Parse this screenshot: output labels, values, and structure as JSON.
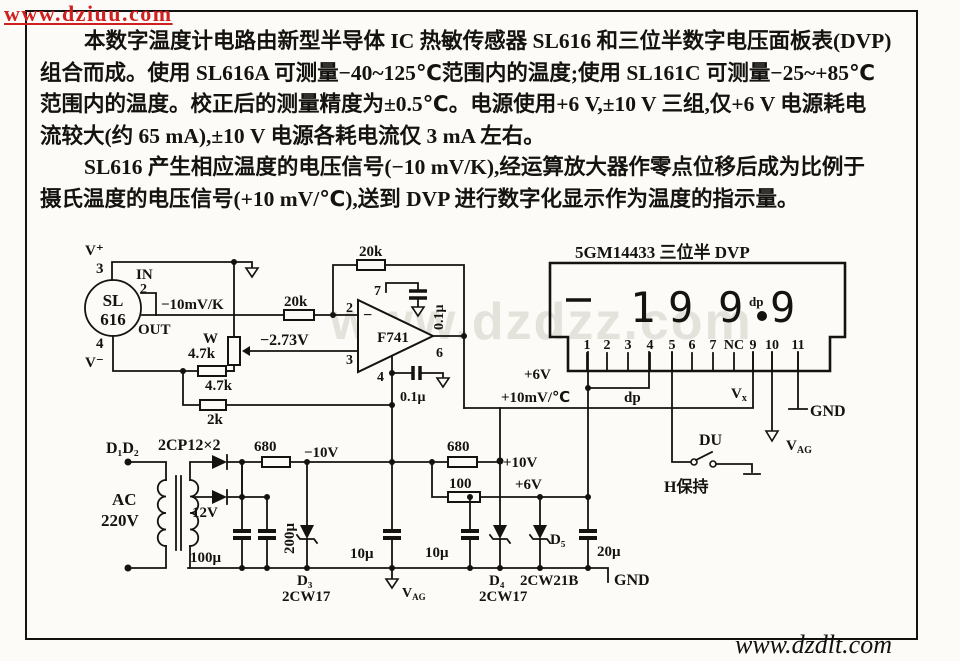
{
  "watermarks": {
    "top_left": "www.dziuu.com",
    "center": "www.dzdzz.com",
    "bottom_right": "www.dzdlt.com"
  },
  "intro": {
    "lines": [
      "本数字温度计电路由新型半导体 IC 热敏传感器 SL616 和三位半数字电压面板表(DVP)",
      "组合而成。使用 SL616A 可测量−40~125℃范围内的温度;使用 SL161C 可测量−25~+85℃",
      "范围内的温度。校正后的测量精度为±0.5℃。电源使用+6 V,±10 V 三组,仅+6 V 电源耗电",
      "流较大(约 65 mA),±10 V 电源各耗电流仅 3 mA 左右。",
      "SL616 产生相应温度的电压信号(−10 mV/K),经运算放大器作零点位移后成为比例于",
      "摄氏温度的电压信号(+10 mV/℃),送到 DVP 进行数字化显示作为温度的指示量。"
    ]
  },
  "schematic": {
    "sensor": {
      "name_top": "SL",
      "name_bottom": "616",
      "v_plus": "V⁺",
      "v_minus": "V⁻",
      "pin3": "3",
      "pin2": "2",
      "pin4": "4",
      "in": "IN",
      "out": "OUT",
      "sensitivity": "−10mV/K"
    },
    "front": {
      "r_series": "20k",
      "pot_name": "W",
      "pot_value": "4.7k",
      "offset": "−2.73V",
      "r_lower": "4.7k",
      "r_bottom": "2k"
    },
    "opamp": {
      "r_feedback": "20k",
      "name": "F741",
      "sign": "−",
      "pin2": "2",
      "pin3": "3",
      "pin7": "7",
      "pin4": "4",
      "pin6": "6",
      "cap_top": "0.1μ",
      "cap_bottom": "0.1μ"
    },
    "dvp": {
      "title": "5GM14433 三位半 DVP",
      "digit1": "1",
      "digit2": "9",
      "digit3": "9",
      "digit4": "9",
      "dp": "dp",
      "pins": [
        "1",
        "2",
        "3",
        "4",
        "5",
        "6",
        "7",
        "NC",
        "9",
        "10",
        "11"
      ],
      "supply": "+6V",
      "signal": "+10mV/℃",
      "dp_wire": "dp",
      "vx_main": "V",
      "vx_sub": "x",
      "gnd": "GND",
      "vag_main": "V",
      "vag_sub": "AG",
      "du": "DU",
      "hold": "H保持"
    },
    "psu": {
      "diodes": "D₁D₂",
      "diode_type": "2CP12×2",
      "r_neg": "680",
      "neg_rail": "−10V",
      "ac_label": "AC",
      "ac_voltage": "220V",
      "secondary": "12V",
      "c_filter": "100μ",
      "c_filter2": "200μ",
      "d3": "D₃",
      "d3_type": "2CW17",
      "c_neg": "10μ",
      "r_pos": "680",
      "pos_rail": "+10V",
      "r_6v": "100",
      "rail_6v": "+6V",
      "c_6v": "10μ",
      "d4": "D₄",
      "d4_type": "2CW17",
      "d5": "D₅",
      "d5_type": "2CW21B",
      "c_out": "20μ",
      "gnd": "GND",
      "vag_main": "V",
      "vag_sub": "AG"
    }
  }
}
